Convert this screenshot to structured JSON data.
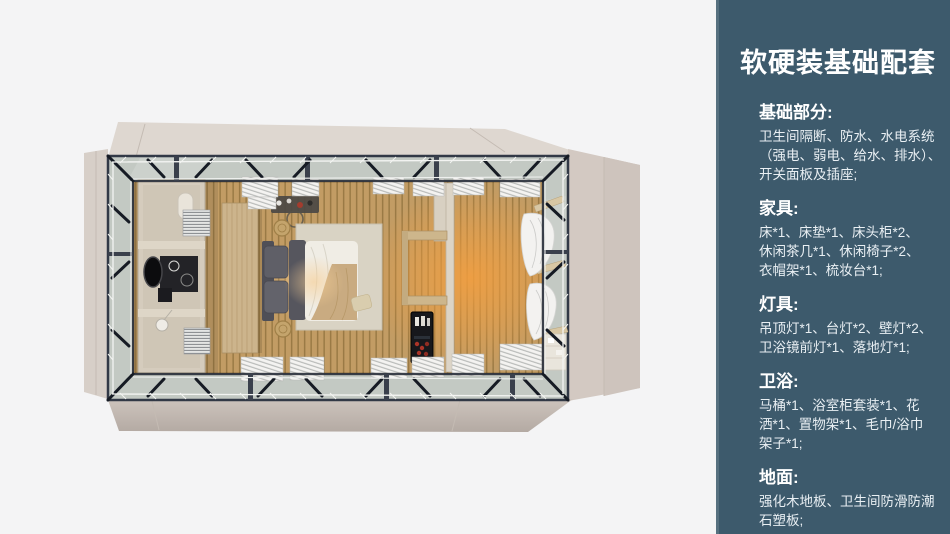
{
  "panel": {
    "title": "软硬装基础配套",
    "sections": [
      {
        "heading": "基础部分:",
        "lines": [
          "卫生间隔断、防水、水电系统",
          "（强电、弱电、给水、排水）、",
          "开关面板及插座;"
        ]
      },
      {
        "heading": "家具:",
        "lines": [
          "床*1、床垫*1、床头柜*2、",
          "休闲茶几*1、休闲椅子*2、",
          "衣帽架*1、梳妆台*1;"
        ]
      },
      {
        "heading": "灯具:",
        "lines": [
          "吊顶灯*1、台灯*2、壁灯*2、",
          "卫浴镜前灯*1、落地灯*1;"
        ]
      },
      {
        "heading": "卫浴:",
        "lines": [
          "马桶*1、浴室柜套装*1、花",
          "洒*1、置物架*1、毛巾/浴巾",
          "架子*1;"
        ]
      },
      {
        "heading": "地面:",
        "lines": [
          "强化木地板、卫生间防滑防潮",
          "石塑板;"
        ]
      }
    ]
  },
  "colors": {
    "page_bg": "#f4f4f5",
    "panel_bg": "#3d5a6c",
    "panel_edge": "#56707f",
    "panel_text": "#ffffff",
    "panel_body": "#e9eff3",
    "canvas_top": "#ded7d0",
    "canvas_left": "#d7cfc8",
    "canvas_right": "#d3c9c2",
    "canvas_right_dark": "#cec4bd",
    "canvas_fold": "#c4bbb3",
    "canvas_b1": "#cdc4bd",
    "canvas_b2": "#b4aaa3",
    "frame": "#323946",
    "brace": "#161b24",
    "glass": "#c3c9c3",
    "wood_base": "#c29c64",
    "wood_gap": "#9a7a45",
    "glow": "#f59f3e",
    "glow_soft": "#f7cf96",
    "cream": "#d5ccbd",
    "curtain": "#f4f3f1",
    "curtain_line": "#b4b6b4"
  }
}
